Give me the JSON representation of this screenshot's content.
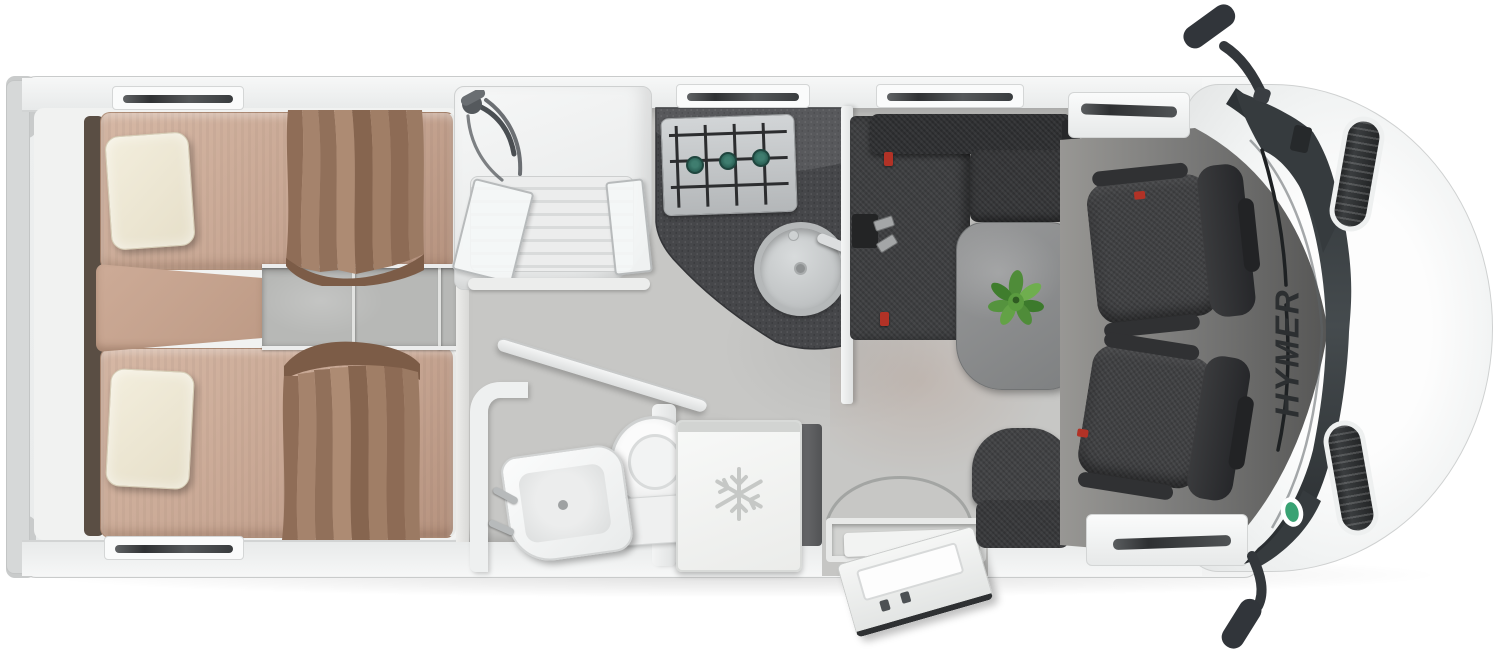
{
  "page": {
    "title": "HYMER motorhome floor plan — top view",
    "background": "#ffffff"
  },
  "branding": {
    "logo_text": "HYMER",
    "logo_color": "#2c2f31"
  },
  "colors": {
    "body_white": "#f2f3f3",
    "hood_white": "#fbfcfc",
    "outline_grey": "#c6c8c8",
    "floor_light": "#c7c7c5",
    "floor_cab_dark": "#616160",
    "mattress_tan": "#c8a794",
    "pillow_cream": "#ede7d4",
    "curtain_brown": "#9b7a63",
    "headboard_brown": "#5a4e44",
    "counter_dark": "#46474a",
    "hob_steel": "#c2c5c7",
    "burner_teal": "#2e6e63",
    "upholstery_charcoal": "#3d3e40",
    "table_grey": "#8a8c8d",
    "plant_green": "#55933e",
    "seatbelt_red": "#b23226",
    "badge_green": "#39a273",
    "glass_dark": "#33383b",
    "fixture_white": "#f5f6f6",
    "snowflake_grey": "#c6c8c6"
  },
  "areas": {
    "bedroom": {
      "label": "Rear bedroom with twin single beds",
      "bed_top": "Single bed (offside)",
      "bed_bottom": "Single bed (nearside)",
      "center_cushion": "Center cushion between beds",
      "steps": "Bed access steps",
      "pillow": "Pillow",
      "curtain": "Privacy curtain",
      "headboard": "Headboard shelf"
    },
    "shower": {
      "label": "Shower cubicle",
      "head": "Shower head and hose",
      "doors": "Folding shower doors",
      "tray": "Shower tray"
    },
    "kitchen": {
      "label": "Kitchen",
      "counter": "Worktop",
      "hob": "3-burner gas hob",
      "burner": "Gas burner",
      "sink": "Round sink",
      "faucet": "Faucet"
    },
    "bathroom": {
      "label": "Washroom",
      "toilet": "Toilet",
      "basin": "Washbasin",
      "door": "Swivel washroom wall",
      "wall": "Washroom partition wall",
      "flush": "Door swing arrow"
    },
    "fridge": {
      "label": "Refrigerator",
      "icon": "Snowflake symbol"
    },
    "lounge": {
      "label": "L-shaped dinette lounge",
      "bench": "L-sofa bench",
      "backrest": "Sofa backrest",
      "table": "Dinette table",
      "plant": "Plant",
      "travel_seat": "Travel seat",
      "belts": "Seat-belt anchors and buckles"
    },
    "cab": {
      "label": "Driver cab",
      "seat_driver": "Swivelled pilot seat (driver)",
      "seat_passenger": "Swivelled pilot seat (passenger)",
      "floor": "Cab floor",
      "door_driver": "Cab door sill (driver)",
      "door_passenger": "Cab door sill (passenger)"
    },
    "exterior": {
      "label": "Vehicle exterior",
      "hood": "Bonnet",
      "windshield": "Windscreen",
      "wiper": "Windscreen wiper",
      "mirror_driver": "Side mirror (driver)",
      "mirror_passenger": "Side mirror (passenger)",
      "vent": "Bonnet air vent",
      "badge": "Windscreen badge",
      "entry_door": "Entrance door (open)",
      "entry_step": "Entrance step",
      "door_arc": "Door swing arc",
      "rear": "Rear panel and bumper",
      "window": "Window / rooflight"
    }
  }
}
